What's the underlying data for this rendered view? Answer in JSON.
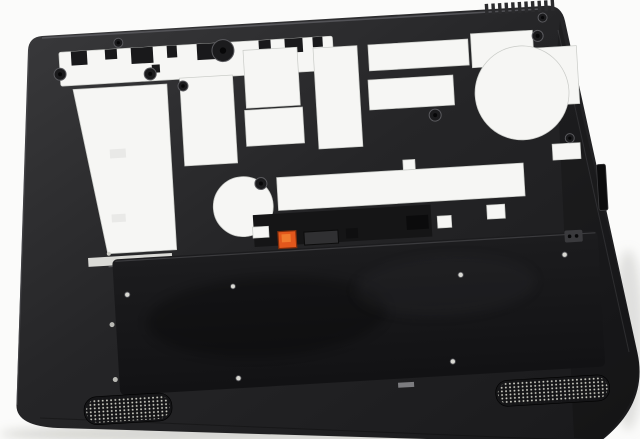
{
  "scene": {
    "subject": "Interior view of a black laptop bottom base cover enclosure, tilted on a white background",
    "orientation_deg": -3.4,
    "background": "#fbfbfa"
  },
  "colors": {
    "bg": "#fbfbfa",
    "case_light": "#3a3a3c",
    "case_mid": "#252527",
    "case_deep": "#19191b",
    "rim_highlight": "#5a5a5e",
    "cutout": "#f6f6f4",
    "cutout_edge": "#c9cbc7",
    "slit": "#dadad6",
    "bay_top": "#1c1c1e",
    "bay_bottom": "#121214",
    "grille_dot": "#d6d6cc",
    "metal_dot": "#d9d9d3",
    "orange": "#e2571c",
    "orange_dark": "#7d2c0c",
    "orange_light": "#f07b2e",
    "shadow": "#b9b9b4"
  },
  "components": [
    "outer-shell",
    "top-rim-cutouts",
    "hinge-boss-cluster",
    "palmrest-frame-cutouts",
    "fan-opening",
    "heatsink-strip-cutouts",
    "mid-board-slot",
    "round-keyhole-cutout",
    "battery-latch-slots",
    "sim-ejector-orange",
    "battery-bay",
    "bay-screw-holes",
    "side-port-slot",
    "speaker-grille-left",
    "speaker-grille-right",
    "vent-fins",
    "screw-bosses"
  ]
}
